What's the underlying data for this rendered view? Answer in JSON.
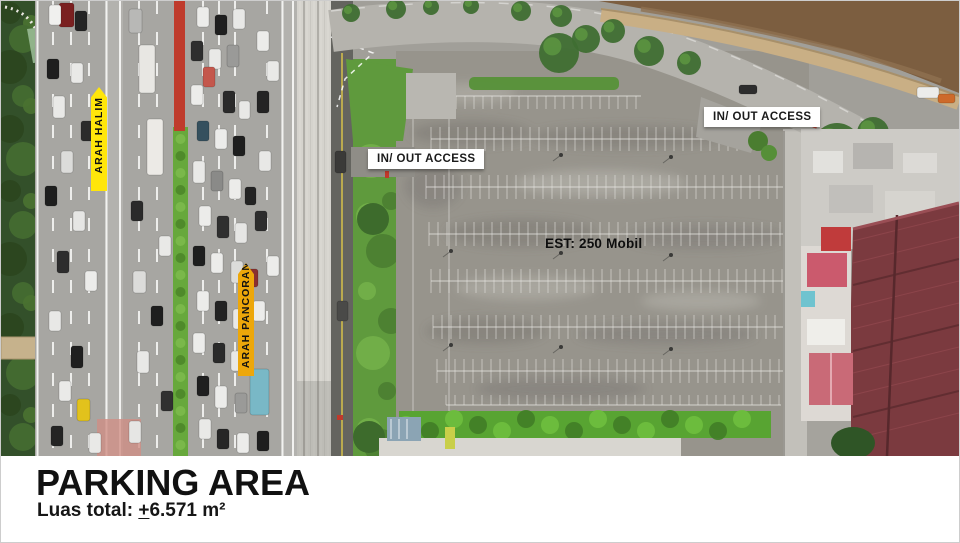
{
  "scene": {
    "labels": {
      "direction_halim": "ARAH HALIM",
      "direction_pancoran": "ARAH PANCORAN",
      "access_left": "IN/ OUT ACCESS",
      "access_right": "IN/ OUT ACCESS",
      "capacity": "EST: 250 Mobil"
    },
    "colors": {
      "halim_banner": "#ffe60a",
      "pancoran_banner": "#eda70a",
      "access_box_bg": "#ffffff",
      "access_box_text": "#1a1a1a"
    }
  },
  "caption": {
    "title": "PARKING AREA",
    "subtitle_prefix": "Luas total: ",
    "subtitle_plusminus": "+",
    "subtitle_value": "6.571 m²"
  }
}
